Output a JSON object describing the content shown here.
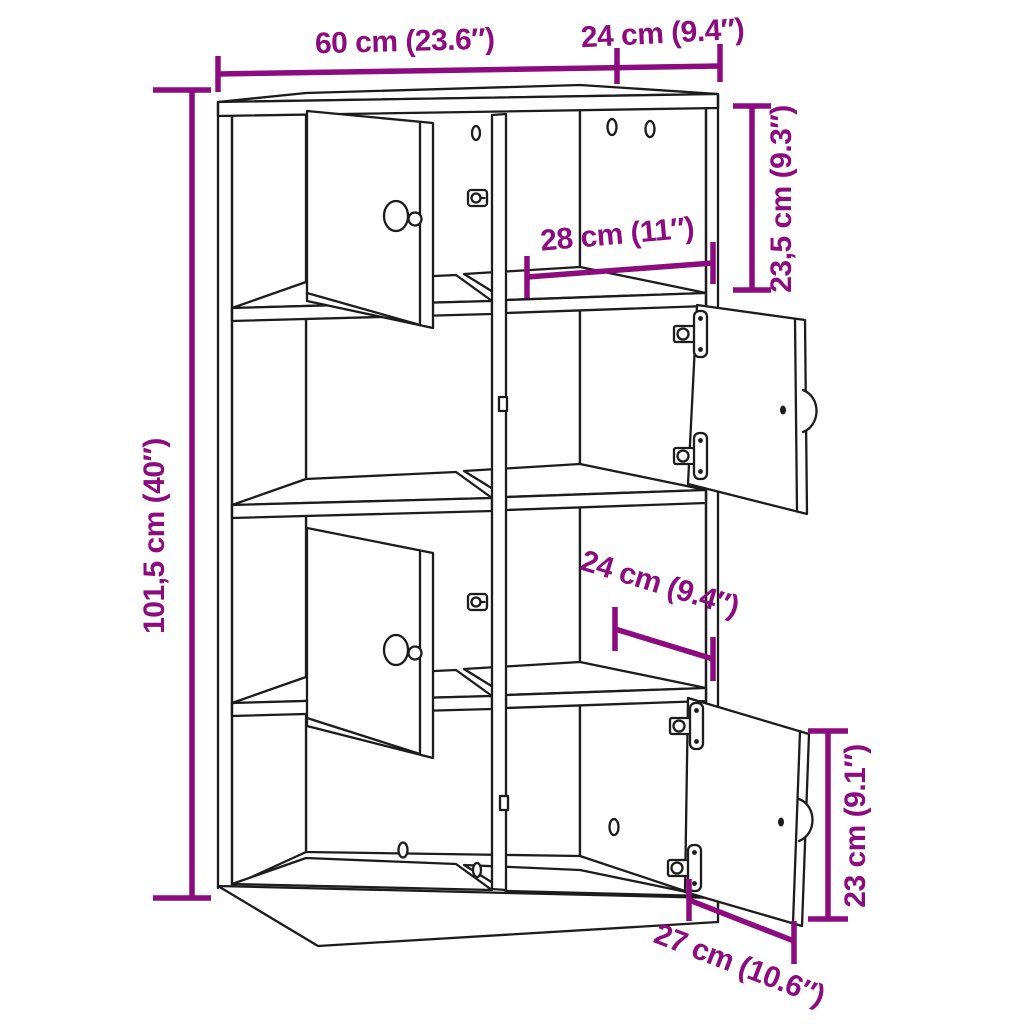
{
  "diagram": {
    "subject": "bookcase with 8 compartments and 4 doors",
    "style": "technical dimension line drawing",
    "colors": {
      "accent": "#8c0c80",
      "line": "#1c1c1c",
      "background": "#ffffff"
    }
  },
  "dimensions": {
    "width_top": "60 cm (23.6″)",
    "depth_top": "24 cm (9.4″)",
    "compartment_height": "23,5 cm (9.3″)",
    "inner_width": "28 cm (11″)",
    "total_height": "101,5 cm (40″)",
    "inner_depth": "24 cm (9.4″)",
    "door_height": "23 cm (9.1″)",
    "door_width": "27 cm (10.6″)"
  }
}
